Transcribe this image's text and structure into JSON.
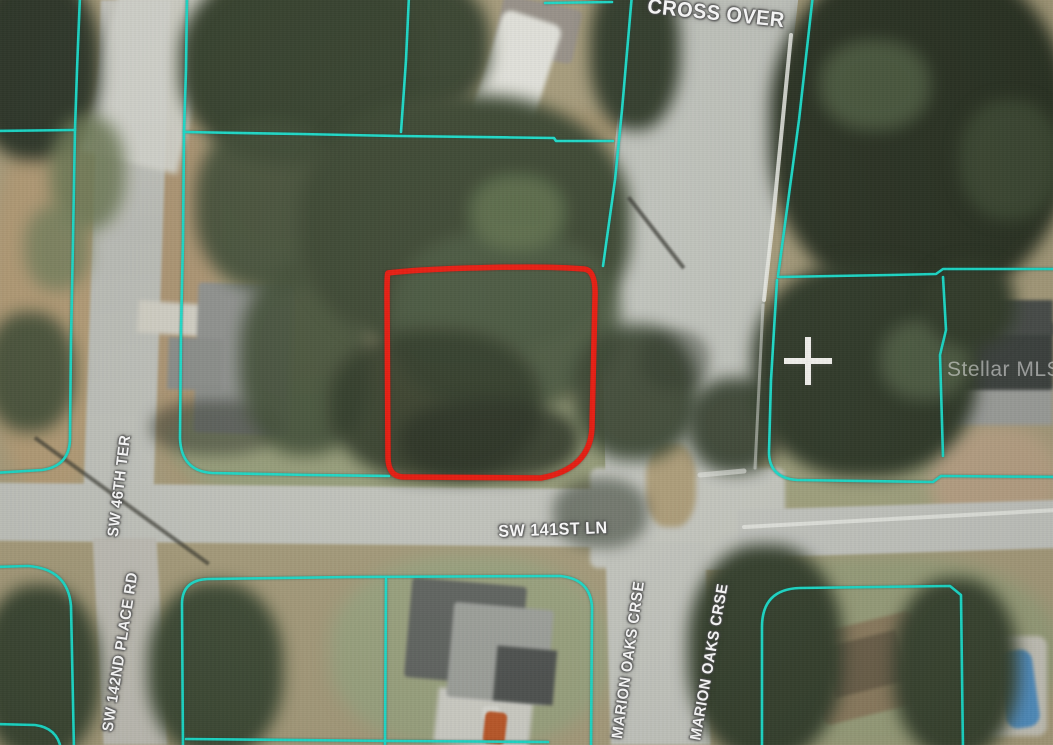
{
  "map": {
    "street_labels": [
      {
        "id": "cross-over",
        "text": "CROSS OVER"
      },
      {
        "id": "sw-46th-ter",
        "text": "SW 46TH TER"
      },
      {
        "id": "sw-142nd-place-rd",
        "text": "SW 142ND PLACE RD"
      },
      {
        "id": "sw-141st-ln",
        "text": "SW 141ST LN"
      },
      {
        "id": "marion-oaks-crse-west",
        "text": "MARION OAKS CRSE"
      },
      {
        "id": "marion-oaks-crse-east",
        "text": "MARION OAKS CRSE"
      }
    ],
    "watermark": {
      "text": "Stellar MLS"
    },
    "colors": {
      "parcel_boundary": "#1bdcca",
      "subject_parcel_outline": "#e8170b",
      "street_label_text": "#ffffff"
    }
  }
}
